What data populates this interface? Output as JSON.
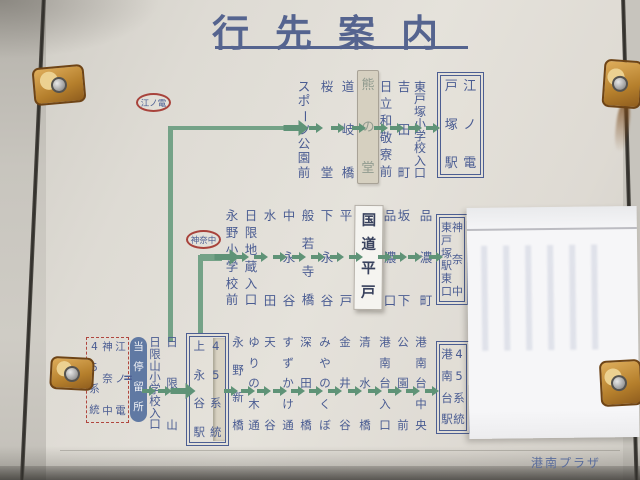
{
  "title": "行先案内",
  "footer": {
    "brand": "港南プラザ"
  },
  "legend": {
    "columns": [
      "45系統",
      "神奈中",
      "江ノ電"
    ],
    "equals": "=",
    "pill": "当停留所"
  },
  "colors": {
    "ink_blue": "#4a5c92",
    "route_green": "#74a287",
    "badge_red": "#a8433c",
    "panel": "#e5e2db",
    "pill_bg": "#6079a3"
  },
  "routes": [
    {
      "badge": "江ノ電",
      "items": [
        {
          "type": "stop",
          "label": "スポーツ公園前"
        },
        {
          "type": "stop",
          "label": "桜堂"
        },
        {
          "type": "stop",
          "label": "道岐橋"
        },
        {
          "type": "plate",
          "style": "aged",
          "label": "熊の堂"
        },
        {
          "type": "stop",
          "label": "日立和敬寮前"
        },
        {
          "type": "stop",
          "label": "吉田町"
        },
        {
          "type": "stop",
          "label": "東戸塚小学校入口"
        },
        {
          "type": "dest",
          "operator": "江ノ電",
          "station": "戸塚駅"
        }
      ]
    },
    {
      "badge": "神奈中",
      "items": [
        {
          "type": "stop",
          "label": "永野小学校前"
        },
        {
          "type": "stop",
          "label": "日限地蔵入口"
        },
        {
          "type": "stop",
          "label": "水田"
        },
        {
          "type": "stop",
          "label": "中永谷"
        },
        {
          "type": "stop",
          "label": "般若寺橋"
        },
        {
          "type": "stop",
          "label": "下永谷"
        },
        {
          "type": "stop",
          "label": "平戸"
        },
        {
          "type": "plate",
          "style": "current",
          "label": "国道平戸"
        },
        {
          "type": "stop",
          "label": "品濃口"
        },
        {
          "type": "stop",
          "label": "坂下"
        },
        {
          "type": "stop",
          "label": "品濃町"
        },
        {
          "type": "dest",
          "operator": "神奈中",
          "station": "東戸塚駅東口"
        }
      ]
    },
    {
      "badge": null,
      "items": [
        {
          "type": "stop",
          "label": "日限山小学校入口"
        },
        {
          "type": "stop",
          "label": "日限山"
        },
        {
          "type": "hub",
          "station": "上永谷駅",
          "route": "45系統",
          "taped": true
        },
        {
          "type": "stop",
          "label": "永野新橋"
        },
        {
          "type": "stop",
          "label": "ゆりの木通"
        },
        {
          "type": "stop",
          "label": "天谷"
        },
        {
          "type": "stop",
          "label": "すずかけ通"
        },
        {
          "type": "stop",
          "label": "深田橋"
        },
        {
          "type": "stop",
          "label": "みやのくぼ"
        },
        {
          "type": "stop",
          "label": "金井谷"
        },
        {
          "type": "stop",
          "label": "清水橋"
        },
        {
          "type": "stop",
          "label": "港南台入口"
        },
        {
          "type": "stop",
          "label": "公園前"
        },
        {
          "type": "stop",
          "label": "港南台中央"
        },
        {
          "type": "dest",
          "operator": "45系統",
          "station": "港南台駅"
        }
      ]
    }
  ]
}
